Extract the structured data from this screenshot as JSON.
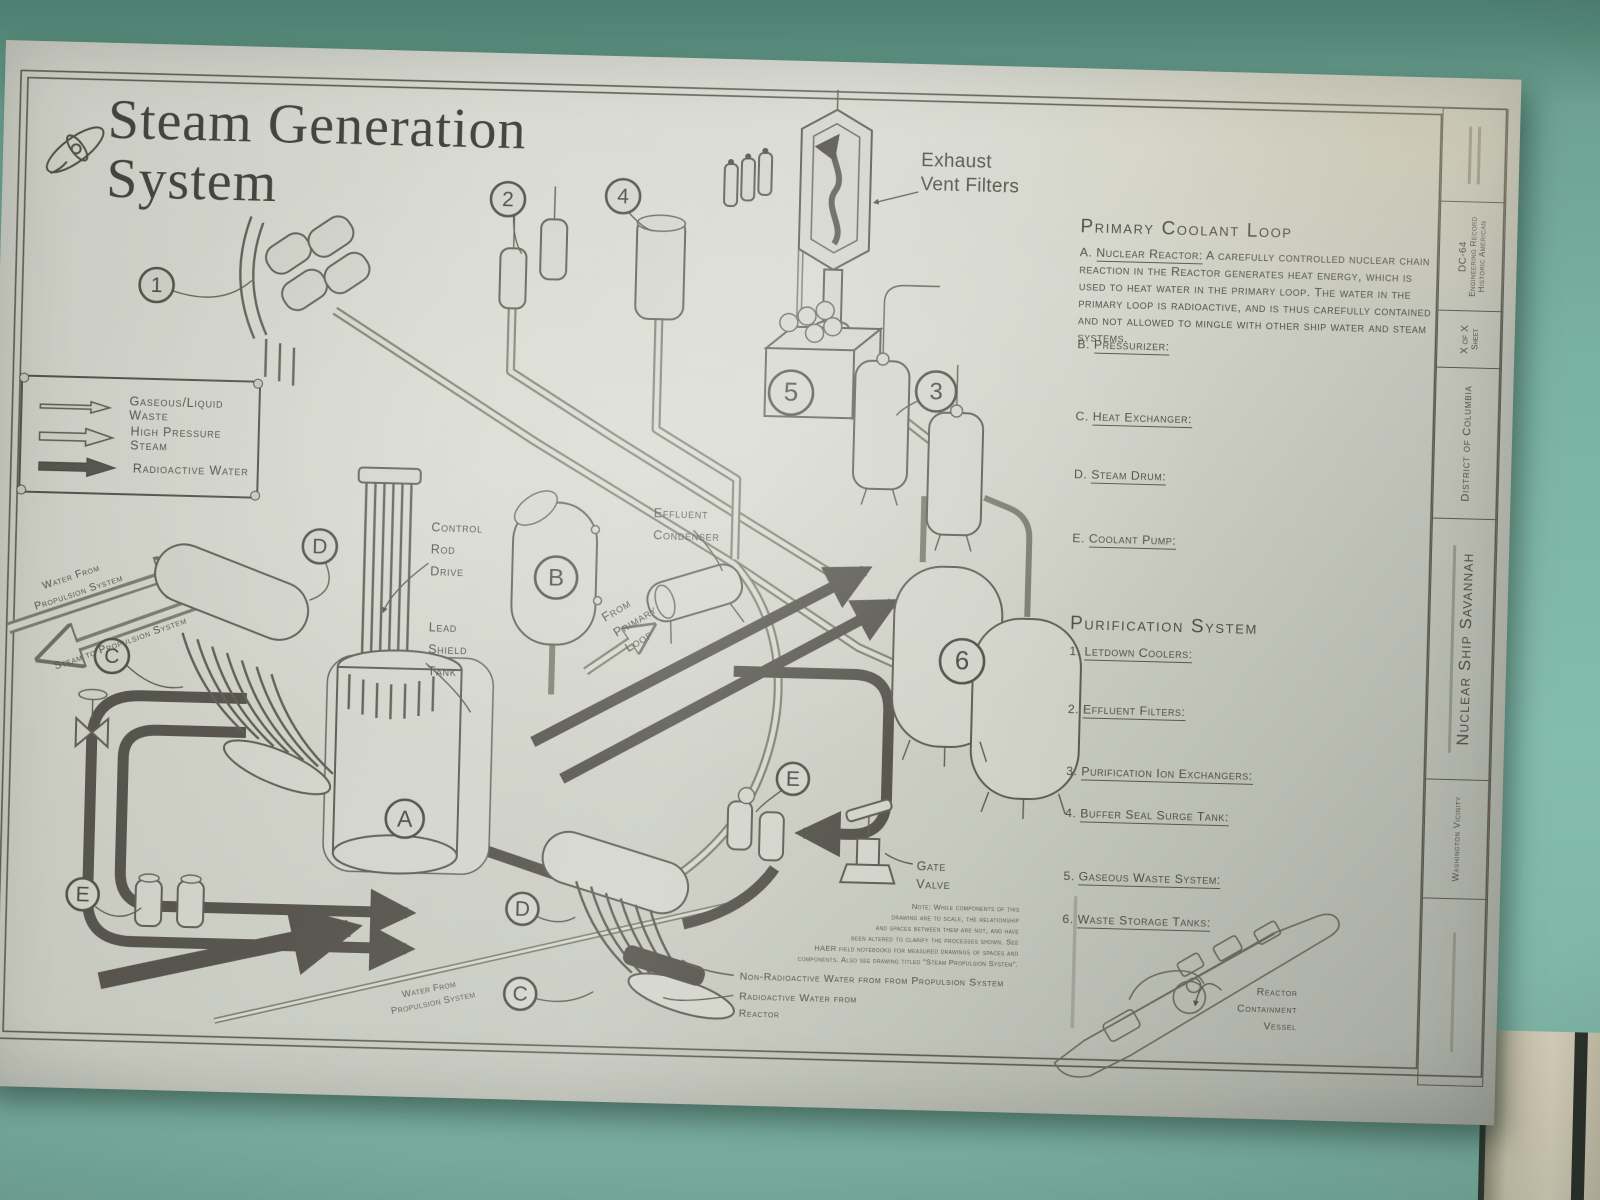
{
  "colors": {
    "wall_teal": "#79b1a2",
    "paper": "#d2d4ca",
    "ink": "#4a4940",
    "dark_pipe": "#4f4d45"
  },
  "poster": {
    "title": {
      "line1": "Steam Generation",
      "line2": "System"
    },
    "legend": {
      "item1": "Gaseous/Liquid Waste",
      "item2": "High Pressure Steam",
      "item3": "Radioactive Water"
    },
    "primary_loop": {
      "heading": "Primary Coolant Loop",
      "a_key": "A.",
      "a_term": "Nuclear Reactor:",
      "a_desc": "A carefully controlled nuclear chain reaction in the Reactor generates heat energy, which is used to heat water in the primary loop. The water in the primary loop is radioactive, and is thus carefully contained and not allowed to mingle with other ship water and steam systems.",
      "b_key": "B.",
      "b_term": "Pressurizer:",
      "c_key": "C.",
      "c_term": "Heat Exchanger:",
      "d_key": "D.",
      "d_term": "Steam Drum:",
      "e_key": "E.",
      "e_term": "Coolant Pump:"
    },
    "purification": {
      "heading": "Purification System",
      "i1_key": "1.",
      "i1_term": "Letdown Coolers:",
      "i2_key": "2.",
      "i2_term": "Effluent Filters:",
      "i3_key": "3.",
      "i3_term": "Purification Ion Exchangers:",
      "i4_key": "4.",
      "i4_term": "Buffer Seal Surge Tank:",
      "i5_key": "5.",
      "i5_term": "Gaseous Waste System:",
      "i6_key": "6.",
      "i6_term": "Waste Storage Tanks:"
    },
    "labels": {
      "exhaust1": "Exhaust",
      "exhaust2": "Vent Filters",
      "control_rod1": "Control",
      "control_rod2": "Rod",
      "control_rod3": "Drive",
      "lead_shield1": "Lead",
      "lead_shield2": "Shield",
      "lead_shield3": "Tank",
      "effluent1": "Effluent",
      "effluent2": "Condenser",
      "from1": "From",
      "from2": "Primary",
      "from3": "Loop",
      "water_from1": "Water From",
      "water_from2": "Propulsion System",
      "steam_to": "Steam to Propulsion System",
      "steam_to_bottom": "Steam to Propulsion System",
      "water_from_bottom1": "Water From",
      "water_from_bottom2": "Propulsion System",
      "gate1": "Gate",
      "gate2": "Valve",
      "non_radioactive": "Non-Radioactive  Water from from Propulsion System",
      "radioactive1": "Radioactive Water from",
      "radioactive2": "Reactor",
      "containment1": "Reactor",
      "containment2": "Containment",
      "containment3": "Vessel",
      "note1": "Note: While components of this",
      "note2": "drawing are to scale, the relationship",
      "note3": "and spaces between them are not, and have",
      "note4": "been altered to clarify the  processes shown. See",
      "note5": "HAER field notebooks for measured drawings of spaces and",
      "note6": "components. Also see drawing titled \"Steam Propulsion System\"."
    },
    "markers": {
      "n1": "1",
      "n2": "2",
      "n3": "3",
      "n4": "4",
      "n5": "5",
      "n6": "6",
      "a": "A",
      "b": "B",
      "c": "C",
      "d": "D",
      "e": "E"
    },
    "title_block": {
      "haer1": "Historic American",
      "haer2": "Engineering Record",
      "haer3": "DC-64",
      "sheet_label": "Sheet",
      "sheet_value": "X of X",
      "district": "District of Columbia",
      "ship": "Nuclear Ship Savannah",
      "vicinity": "Washington Vicinity"
    }
  }
}
